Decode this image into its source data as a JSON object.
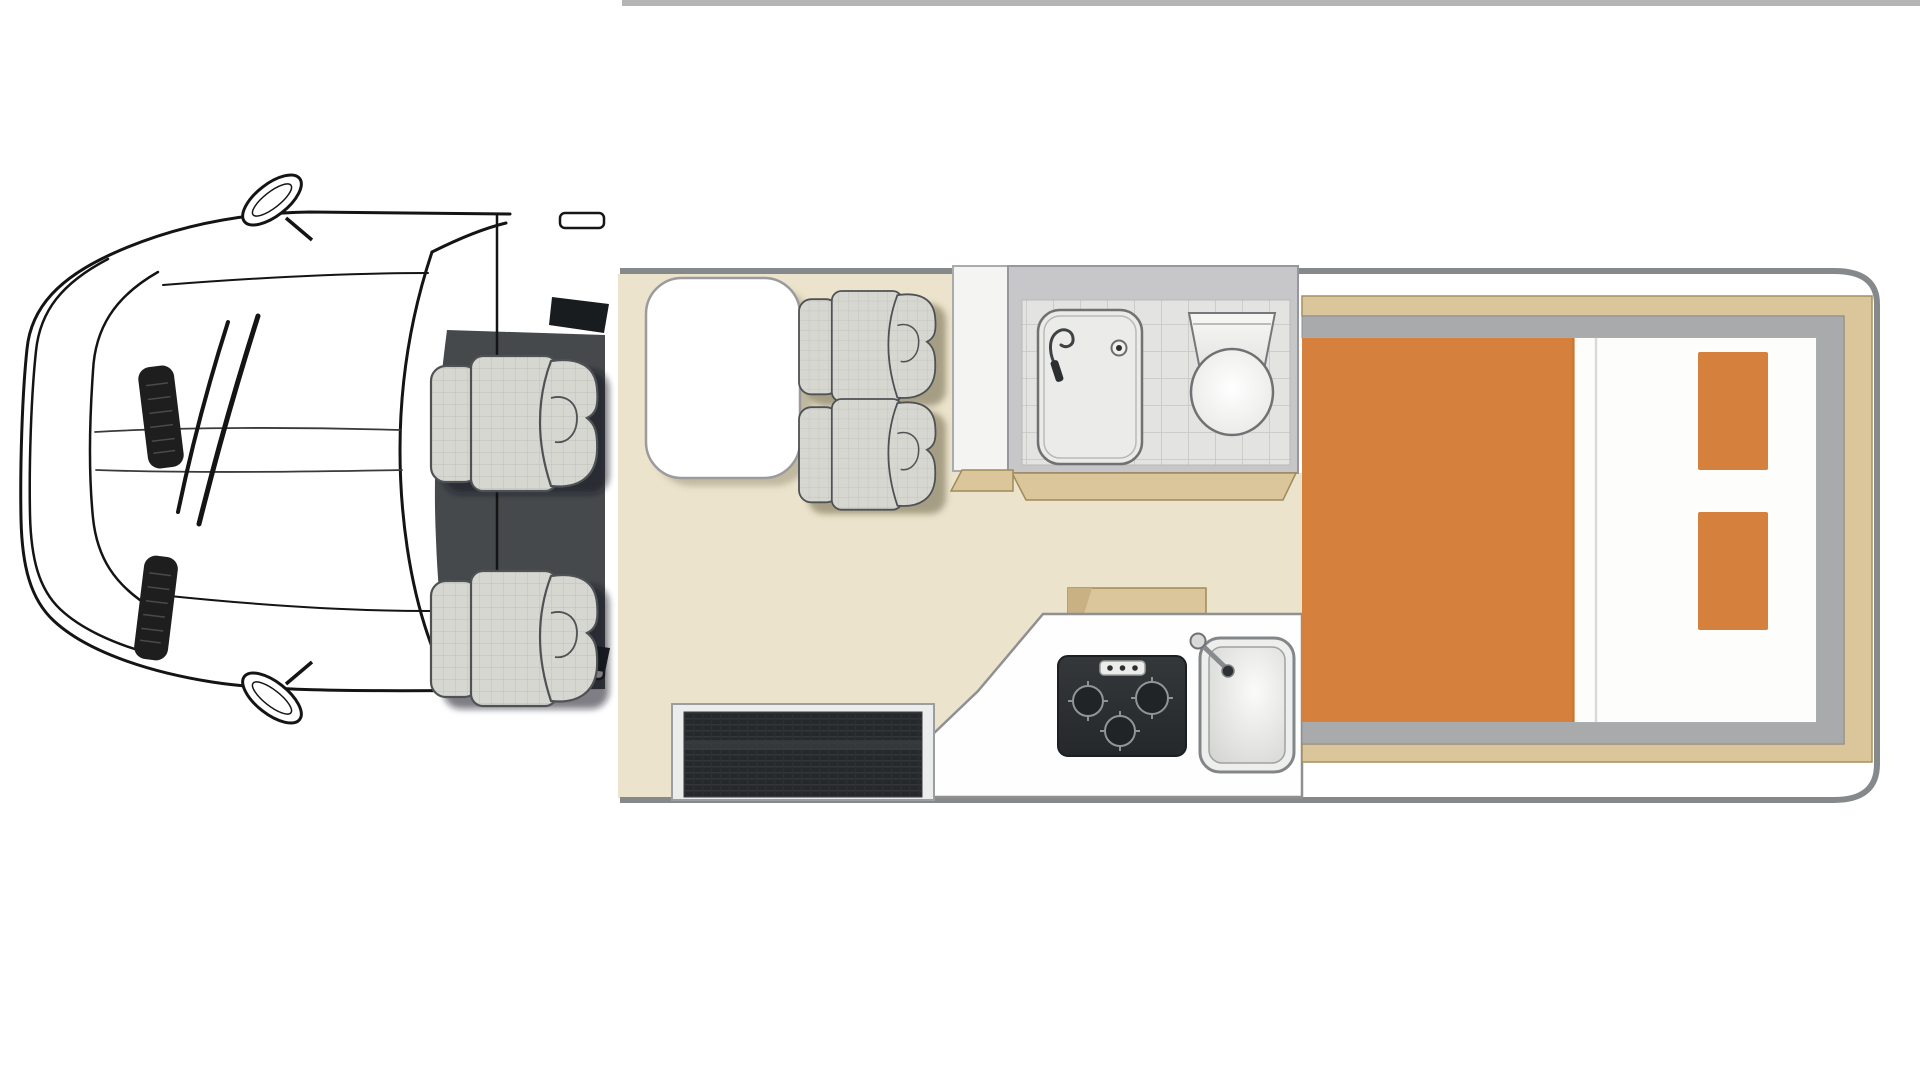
{
  "meta": {
    "description": "Overhead floor plan of a campervan motorhome",
    "view": "top-down"
  },
  "colors": {
    "floor": "#ebe3cb",
    "accent_orange": "#d5803c",
    "wood": "#dbc69c",
    "wood_edge": "#a08a58",
    "body_outline": "#86898b",
    "cab_floor": "#45494c",
    "bathroom": "#c7c7c9",
    "bed_frame": "#a9aaac",
    "top_edge_line": "#b5b5b5",
    "mattress": "#fdfdfc",
    "counter": "#fefefe"
  },
  "cab": {
    "seats": [
      {
        "label": "driver-seat"
      },
      {
        "label": "passenger-seat"
      }
    ],
    "details": [
      "side-mirror-top",
      "side-mirror-bottom",
      "windscreen",
      "wipers",
      "bonnet-vents"
    ]
  },
  "lounge": {
    "table": "dinette-table",
    "seats": [
      {
        "label": "forward-facing-seat-1"
      },
      {
        "label": "forward-facing-seat-2"
      }
    ]
  },
  "bathroom": {
    "fixtures": [
      "shower-tray",
      "toilet"
    ],
    "floor": "tiled"
  },
  "kitchen": {
    "fixtures": [
      "hob",
      "sink"
    ],
    "burner_count": 3
  },
  "bedroom": {
    "bed": "rear-double-bed",
    "pillow_count": 2,
    "bedding": "orange-duvet"
  },
  "entry": {
    "feature": "entry-step"
  }
}
